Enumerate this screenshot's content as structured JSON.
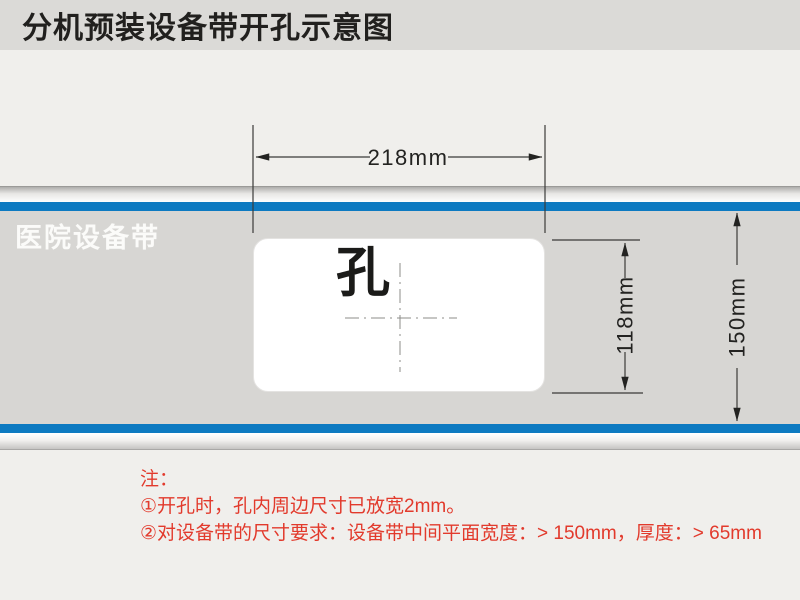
{
  "header": {
    "title": "分机预装设备带开孔示意图"
  },
  "diagram": {
    "belt_label": "医院设备带",
    "hole_label": "孔",
    "dimensions": {
      "opening_width": "218mm",
      "hole_height": "118mm",
      "belt_height": "150mm"
    },
    "colors": {
      "belt_stripe_blue": "#0d7ac1",
      "belt_body_gray": "#d7d6d3",
      "note_red": "#e23a2c",
      "title_bar_gray": "#dbdad7",
      "background": "#f0efec"
    }
  },
  "notes": {
    "heading": "注：",
    "items": [
      "①开孔时，孔内周边尺寸已放宽2mm。",
      "②对设备带的尺寸要求：设备带中间平面宽度：> 150mm，厚度：> 65mm"
    ]
  }
}
